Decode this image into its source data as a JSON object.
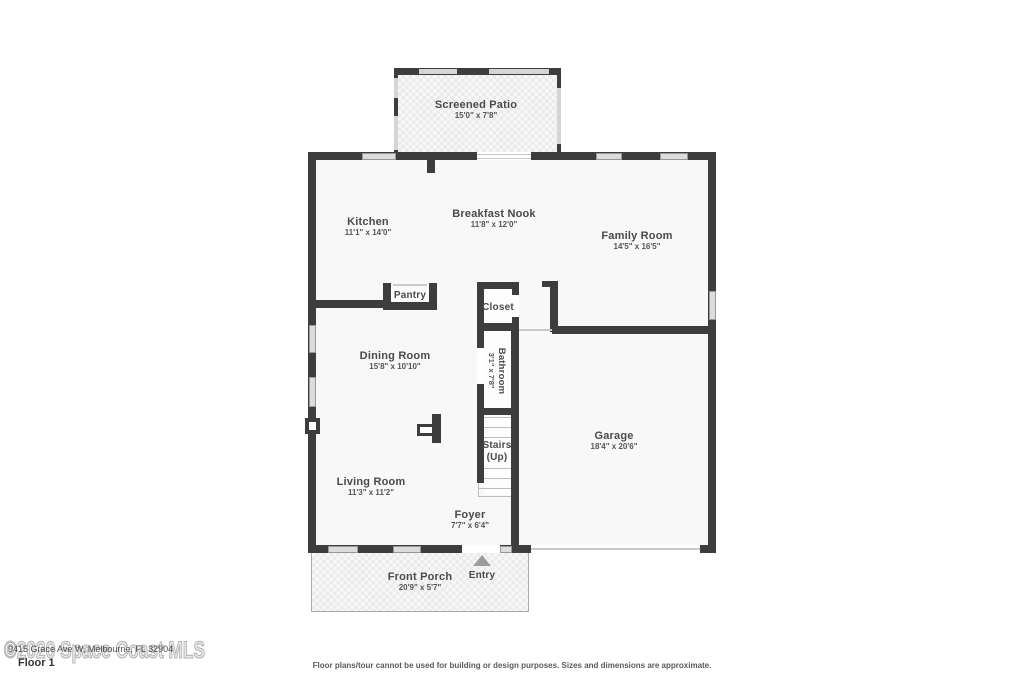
{
  "floor": {
    "label": "Floor 1"
  },
  "watermark": {
    "text": "©2020 Space Coast MLS",
    "address": "9415 Grace Ave W, Melbourne, FL 32904"
  },
  "disclaimer": "Floor plans/tour cannot be used for building or design purposes. Sizes and dimensions are approximate.",
  "rooms": [
    {
      "name": "Screened Patio",
      "dims": "15'0\" x 7'8\""
    },
    {
      "name": "Kitchen",
      "dims": "11'1\" x 14'0\""
    },
    {
      "name": "Breakfast Nook",
      "dims": "11'8\" x 12'0\""
    },
    {
      "name": "Family Room",
      "dims": "14'5\" x 16'5\""
    },
    {
      "name": "Pantry"
    },
    {
      "name": "Closet"
    },
    {
      "name": "Dining Room",
      "dims": "15'8\" x 10'10\""
    },
    {
      "name": "Bathroom",
      "dims": "3'1\" x 7'8\""
    },
    {
      "name": "Stairs",
      "dims": "(Up)"
    },
    {
      "name": "Garage",
      "dims": "18'4\" x 20'6\""
    },
    {
      "name": "Living Room",
      "dims": "11'3\" x 11'2\""
    },
    {
      "name": "Foyer",
      "dims": "7'7\" x 6'4\""
    },
    {
      "name": "Front Porch",
      "dims": "20'9\" x 5'7\""
    },
    {
      "name": "Entry"
    }
  ],
  "colors": {
    "wall": "#3d3d3d",
    "room_fill": "#f8f8f8",
    "window": "#dcdcdc",
    "label_text": "#4a4a4a",
    "watermark": "#b2b2b2"
  }
}
